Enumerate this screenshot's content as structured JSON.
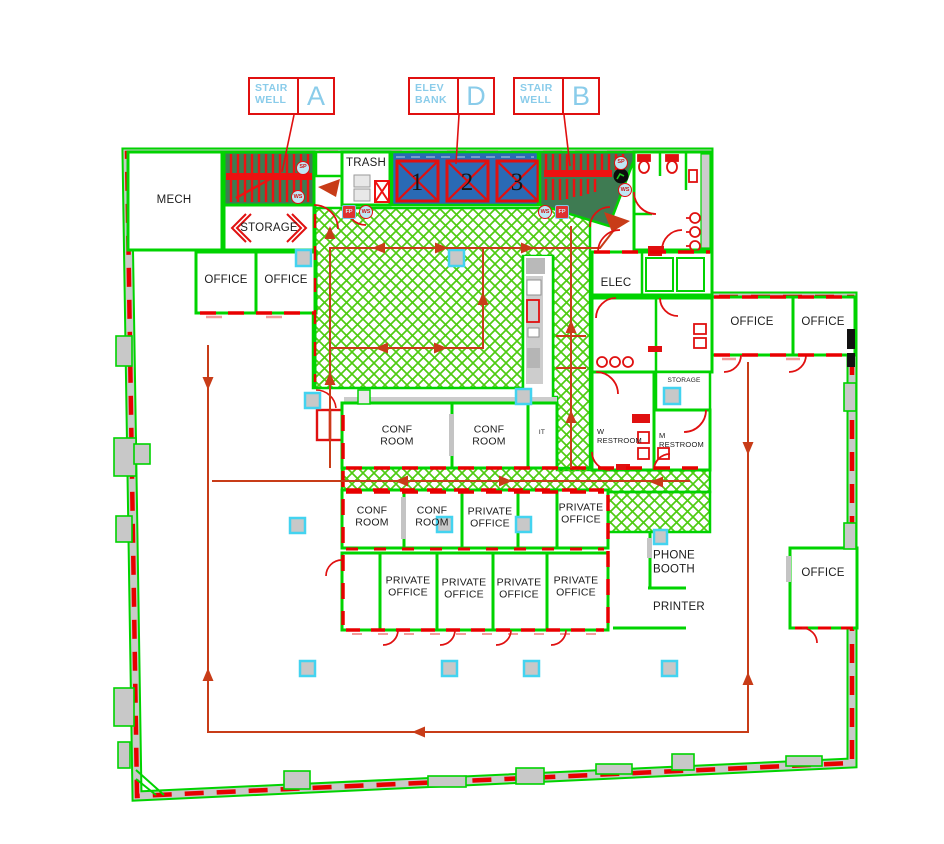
{
  "legend": {
    "stair_a": {
      "name": "STAIR\nWELL",
      "letter": "A"
    },
    "elev_d": {
      "name": "ELEV\nBANK",
      "letter": "D"
    },
    "stair_b": {
      "name": "STAIR\nWELL",
      "letter": "B"
    }
  },
  "rooms": {
    "mech": "MECH",
    "trash": "TRASH",
    "storage_top": "STORAGE",
    "office_a": "OFFICE",
    "office_b": "OFFICE",
    "elec": "ELEC",
    "office_c": "OFFICE",
    "office_d": "OFFICE",
    "storage_small": "STORAGE",
    "w_restroom": "W\nRESTROOM",
    "m_restroom": "M\nRESTROOM",
    "conf_room_1": "CONF\nROOM",
    "conf_room_2": "CONF\nROOM",
    "conf_room_3": "CONF\nROOM",
    "conf_room_4": "CONF\nROOM",
    "it_closet": "IT",
    "private_office_1": "PRIVATE\nOFFICE",
    "private_office_2": "PRIVATE\nOFFICE",
    "private_office_3": "PRIVATE\nOFFICE",
    "private_office_4": "PRIVATE\nOFFICE",
    "private_office_5": "PRIVATE\nOFFICE",
    "private_office_6": "PRIVATE\nOFFICE",
    "phone_booth": "PHONE\nBOOTH",
    "printer": "PRINTER",
    "office_e": "OFFICE"
  },
  "elevators": {
    "cab_1": "1",
    "cab_2": "2",
    "cab_3": "3"
  },
  "icons": {
    "sprinkler": "SP",
    "water_source": "WS",
    "fire_protection": "FP"
  },
  "colors": {
    "wall_green": "#00d300",
    "wall_dash_red": "#e80000",
    "egress_red": "#c83c18",
    "fixture_red": "#e01010",
    "elevator_blue": "#2a6ab5",
    "stair_fill_green": "#3e7b52",
    "hatch_green": "#4fcb12",
    "column_cyan": "#43d3f0",
    "column_gray": "#c8c8c8",
    "legend_blue": "#8accea"
  }
}
